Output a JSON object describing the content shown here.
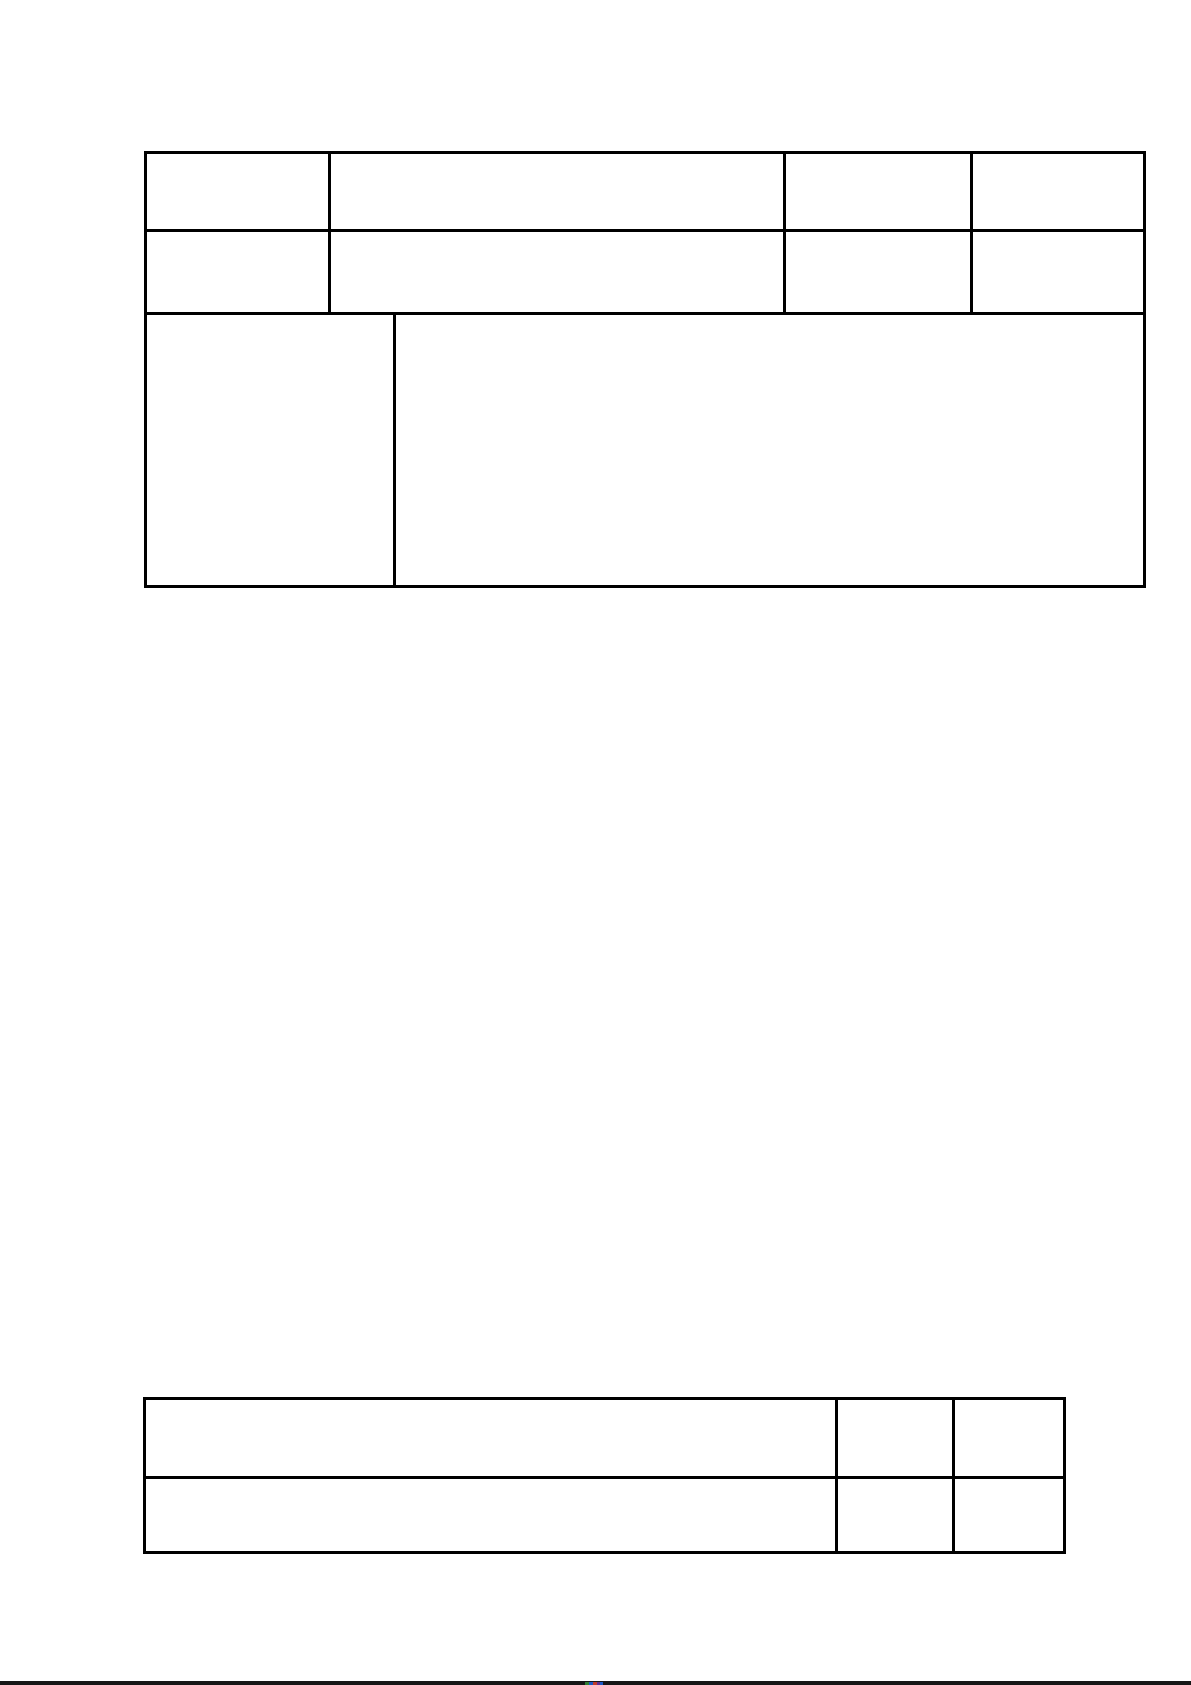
{
  "page": {
    "background_color": "#ffffff",
    "table_border_color": "#000000"
  },
  "table1": {
    "description": "empty 3-row table, rows 1-2 have 4 columns, row 3 has 2 columns",
    "rows": [
      {
        "cells": [
          "",
          "",
          "",
          ""
        ]
      },
      {
        "cells": [
          "",
          "",
          "",
          ""
        ]
      },
      {
        "cells": [
          "",
          ""
        ]
      }
    ]
  },
  "table2": {
    "description": "empty 2-row by 3-column table",
    "rows": [
      {
        "cells": [
          "",
          "",
          ""
        ]
      },
      {
        "cells": [
          "",
          "",
          ""
        ]
      }
    ]
  },
  "page_separator": {
    "bar_color": "#161616",
    "next_page_sliver_colors": [
      "#2e7d32",
      "#1a56c4",
      "#c0392b",
      "#5b2d90"
    ]
  }
}
